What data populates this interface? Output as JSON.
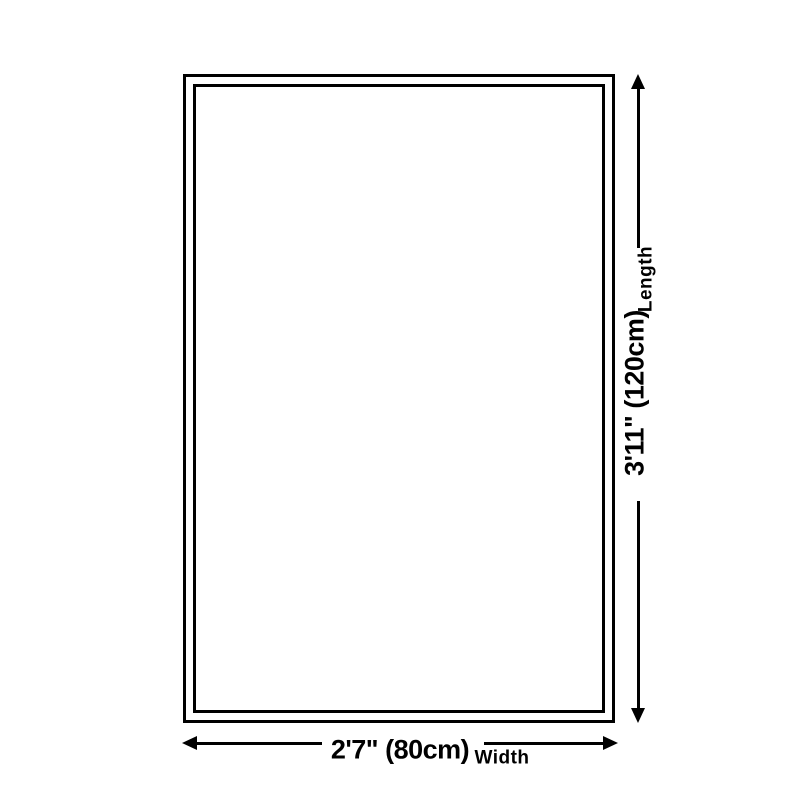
{
  "diagram": {
    "background_color": "#ffffff",
    "outline_color": "#000000",
    "product_outline": "double-border-rectangle",
    "length": {
      "value": "3'11\" (120cm)",
      "label": "Length"
    },
    "width": {
      "value": "2'7\" (80cm)",
      "label": "Width"
    }
  }
}
